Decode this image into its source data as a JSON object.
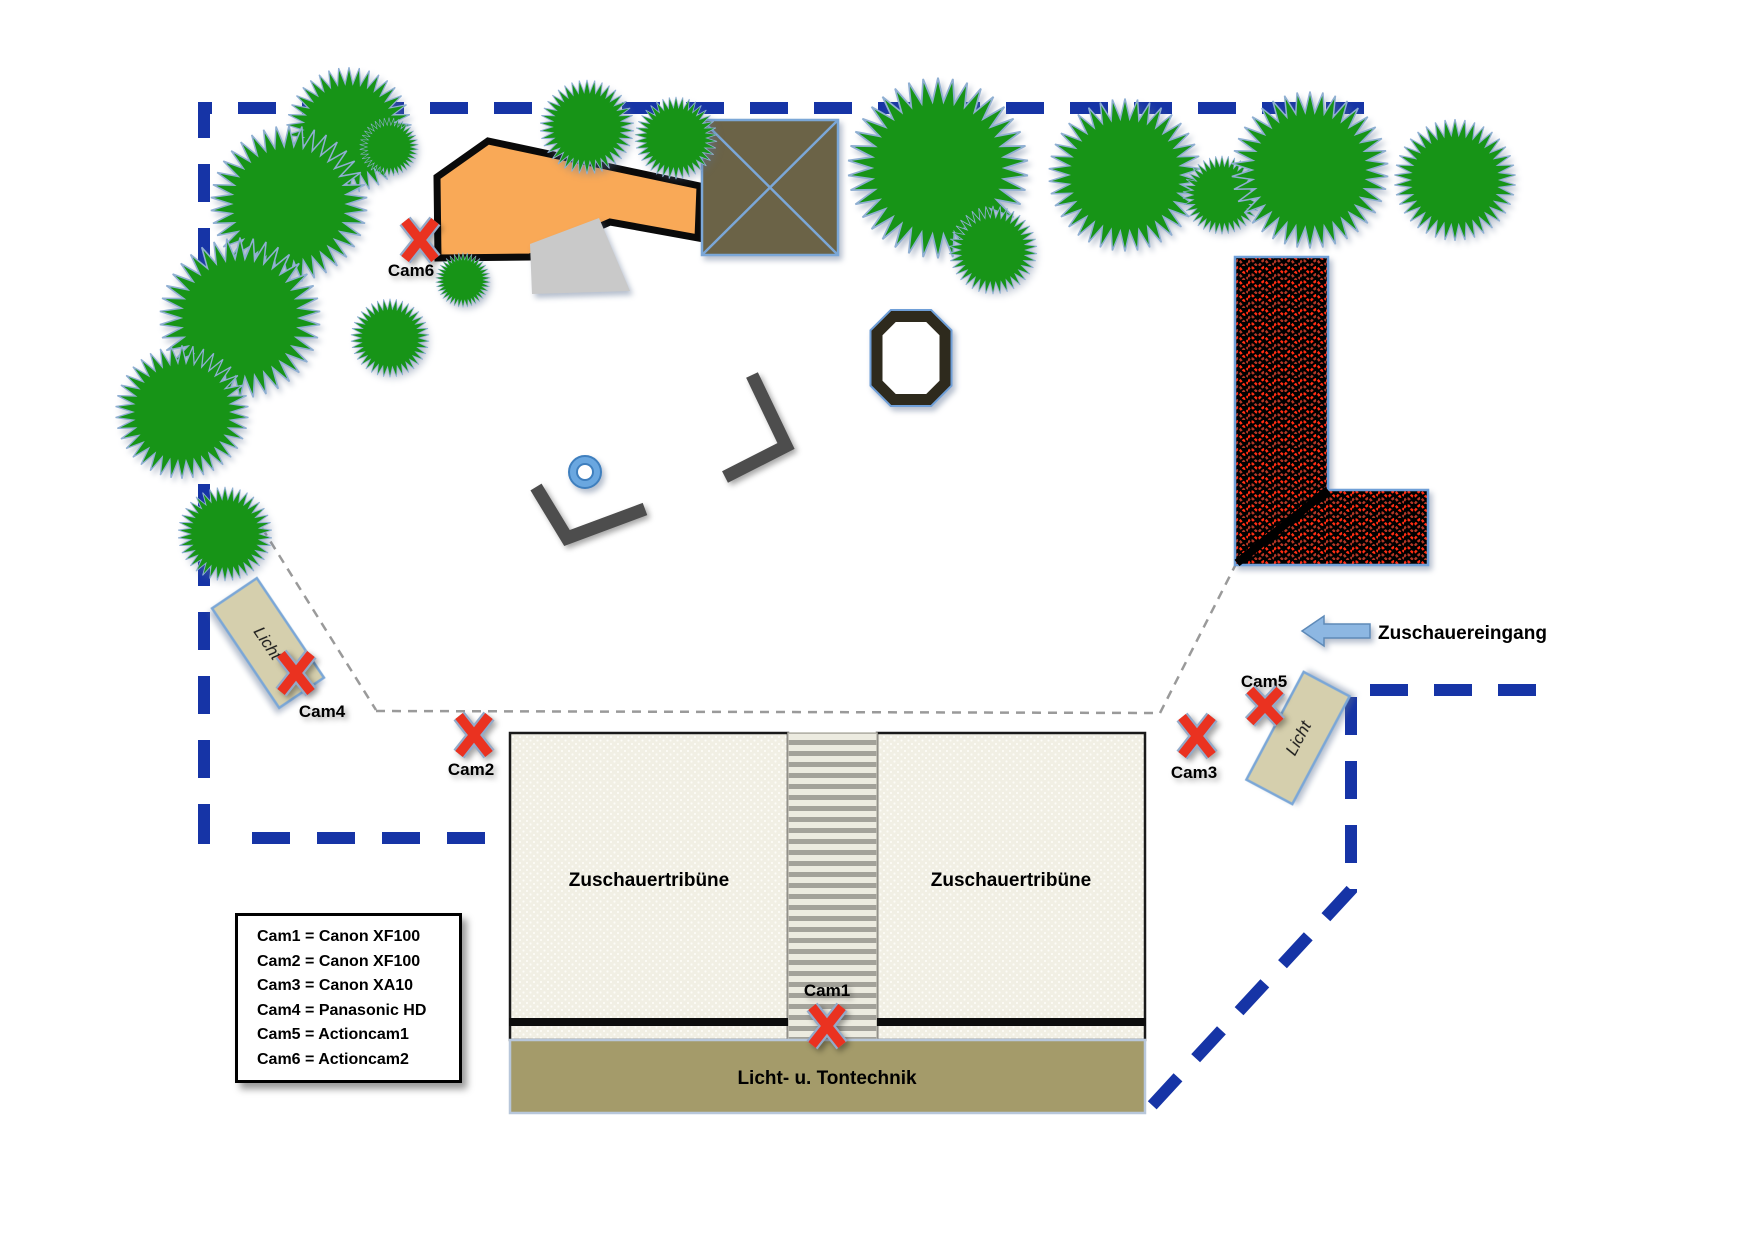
{
  "diagram": {
    "title": "Kamera- und Technikplan (Veranstaltungsgelände)",
    "cam_markers": [
      {
        "id": "cam1",
        "label": "Cam1"
      },
      {
        "id": "cam2",
        "label": "Cam2"
      },
      {
        "id": "cam3",
        "label": "Cam3"
      },
      {
        "id": "cam4",
        "label": "Cam4"
      },
      {
        "id": "cam5",
        "label": "Cam5"
      },
      {
        "id": "cam6",
        "label": "Cam6"
      }
    ],
    "areas": {
      "tribune_left": "Zuschauertribüne",
      "tribune_right": "Zuschauertribüne",
      "tech_bar": "Licht- u. Tontechnik",
      "light_left": "Licht",
      "light_right": "Licht",
      "entrance_label": "Zuschauereingang"
    },
    "legend": {
      "items": [
        "Cam1 = Canon XF100",
        "Cam2 = Canon XF100",
        "Cam3 = Canon XA10",
        "Cam4 = Panasonic HD",
        "Cam5 = Actioncam1",
        "Cam6 = Actioncam2"
      ]
    },
    "colors": {
      "boundary_blue": "#1634a6",
      "tree_green": "#179417",
      "tree_edge_blue": "#8fafd2",
      "stage_orange": "#f9a957",
      "tent_olive": "#6b6347",
      "tent_line_blue": "#7ba7d7",
      "hatch_red": "#ff2d12",
      "hatch_bg": "#000000",
      "marker_red": "#ea3220",
      "tribune_fill": "#f1efe4",
      "tech_khaki": "#a49b6a",
      "licht_beige": "#d5cfad",
      "arrow_blue": "#8db7e2",
      "gray_dash": "#9a9a9a"
    }
  }
}
